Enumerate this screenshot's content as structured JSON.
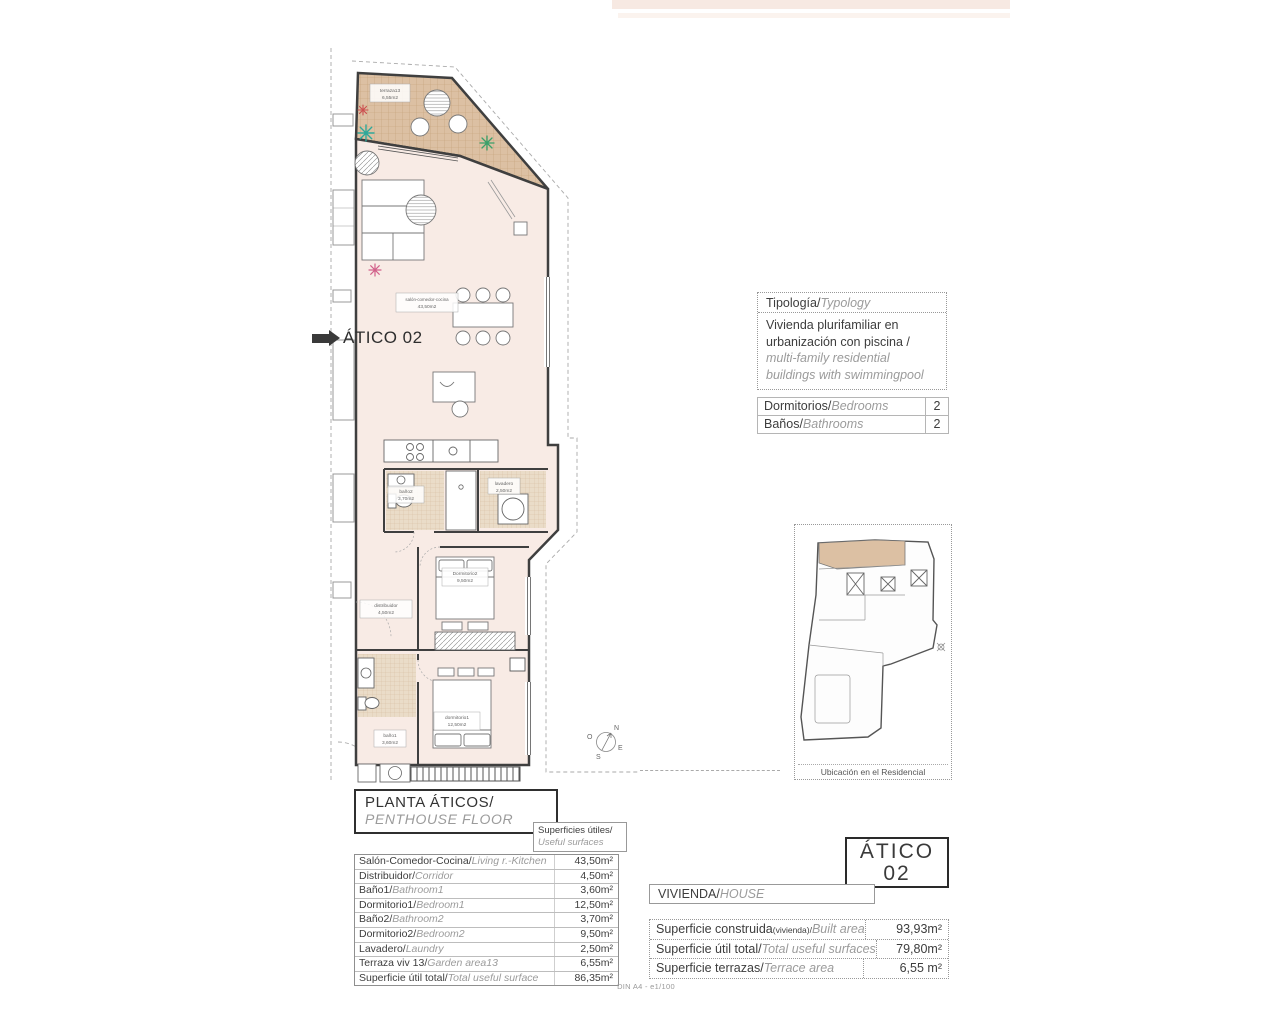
{
  "callout": {
    "label": "ÁTICO 02"
  },
  "plan": {
    "rooms": {
      "terraza": {
        "name": "terraza13",
        "area": "6,55m2"
      },
      "living": {
        "name": "salón-comedor-cocina",
        "area": "43,50m2"
      },
      "bano2": {
        "name": "baño2",
        "area": "3,70m2"
      },
      "lavadero": {
        "name": "lavadero",
        "area": "2,50m2"
      },
      "distribuidor": {
        "name": "distribuidor",
        "area": "4,50m2"
      },
      "dormitorio2": {
        "name": "Dormitorio2",
        "area": "9,50m2"
      },
      "dormitorio1": {
        "name": "dormitorio1",
        "area": "12,50m2"
      },
      "bano1": {
        "name": "baño1",
        "area": "3,60m2"
      }
    },
    "compass": {
      "n": "N",
      "e": "E",
      "s": "S",
      "o": "O"
    }
  },
  "typology": {
    "title_es": "Tipología/",
    "title_en": "Typology",
    "body_es": "Vivienda plurifamiliar en urbanización con piscina  /",
    "body_en": "multi-family residential buildings with swimmingpool"
  },
  "counts": {
    "rows": [
      {
        "es": "Dormitorios/",
        "en": "Bedrooms",
        "value": "2"
      },
      {
        "es": "Baños/",
        "en": "Bathrooms",
        "value": "2"
      }
    ]
  },
  "sitemap": {
    "caption": "Ubicación en el Residencial"
  },
  "floor_title": {
    "es": "PLANTA ÁTICOS/",
    "en": "PENTHOUSE  FLOOR"
  },
  "useful_header": {
    "es": "Superficies útiles/",
    "en": "Useful surfaces"
  },
  "useful_table": {
    "rows": [
      {
        "es": "Salón-Comedor-Cocina/",
        "en": "Living r.-Kitchen",
        "value": "43,50m²"
      },
      {
        "es": "Distribuidor/",
        "en": "Corridor",
        "value": "4,50m²"
      },
      {
        "es": "Baño1/",
        "en": "Bathroom1",
        "value": "3,60m²"
      },
      {
        "es": "Dormitorio1/",
        "en": "Bedroom1",
        "value": "12,50m²"
      },
      {
        "es": "Baño2/",
        "en": "Bathroom2",
        "value": "3,70m²"
      },
      {
        "es": "Dormitorio2/",
        "en": "Bedroom2",
        "value": "9,50m²"
      },
      {
        "es": "Lavadero/",
        "en": "Laundry",
        "value": "2,50m²"
      },
      {
        "es": "Terraza viv 13/",
        "en": "Garden area13",
        "value": "6,55m²"
      },
      {
        "es": "Superficie útil total/",
        "en": "Total useful surface",
        "value": "86,35m²"
      }
    ]
  },
  "unit_box": {
    "line1": "ÁTICO",
    "line2": "02"
  },
  "vivienda": {
    "es": "VIVIENDA/",
    "en": "HOUSE"
  },
  "summary_table": {
    "rows": [
      {
        "es": "Superficie construida",
        "sub": "(vivienda)/",
        "en": "Built area",
        "value": "93,93m²"
      },
      {
        "es": "Superficie útil total/",
        "sub": "",
        "en": "Total useful surfaces",
        "value": "79,80m²"
      },
      {
        "es": "Superficie terrazas/",
        "sub": "",
        "en": "Terrace area",
        "value": "6,55 m²"
      }
    ]
  },
  "page": {
    "footer": "DIN A4 - e1/100"
  }
}
